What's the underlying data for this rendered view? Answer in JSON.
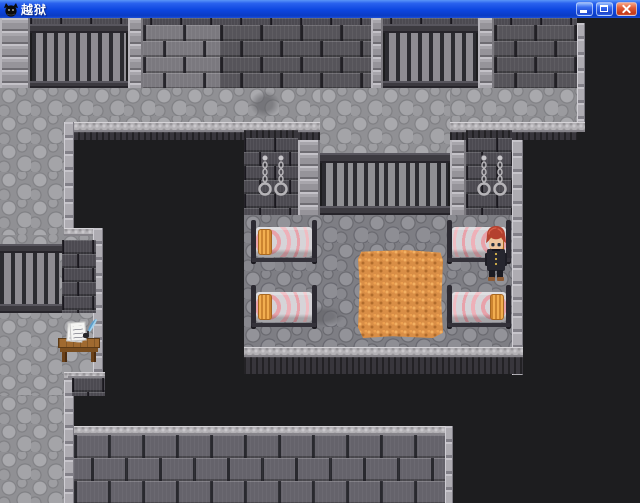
{
  "window": {
    "title": "越狱",
    "icon": "black-creature-icon",
    "controls": {
      "minimize": "minimize",
      "maximize": "maximize",
      "close": "close"
    }
  },
  "scene": {
    "type": "rpg-prison-map",
    "features": {
      "barred_windows": 4,
      "beds": 4,
      "wall_shackle_chains": 4,
      "straw_piles": 1,
      "desks_with_papers": 1,
      "characters": 1
    },
    "character": {
      "hair_color_name": "red",
      "outfit": "dark buttoned uniform"
    },
    "palette": {
      "titlebar_blue": "#0d46e0",
      "close_button_red": "#d8502e",
      "void_black": "#1d1d1f",
      "wall_brick_dark": "#56545a",
      "wall_brick_light": "#7b797f",
      "cell_wall_brick": "#4c4a51",
      "pillar_gray": "#9e9ea2",
      "corridor_cobble": "#909094",
      "cell_floor_cobble": "#7e7e84",
      "ledge_trim": "#b4b2b6",
      "road_brick": "#65636b",
      "window_bar": "#2b2b30",
      "bed_blanket": "#d6d4d8",
      "bed_stripe_pink": "#e8a2aa",
      "pillow_orange": "#f2ae50",
      "straw_orange": "#d98e46",
      "hair_red": "#b4402e",
      "uniform_navy": "#26262f",
      "desk_wood": "#a06a30"
    }
  }
}
